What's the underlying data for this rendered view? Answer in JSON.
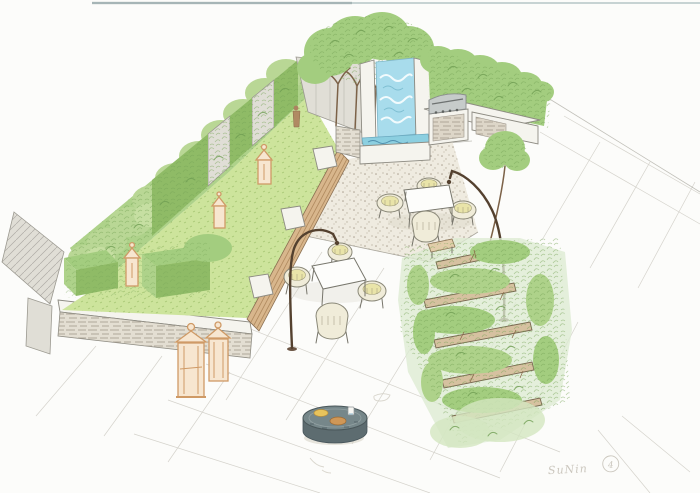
{
  "artwork": {
    "signature": "SuNin",
    "signature_mark": "4"
  },
  "palette": {
    "paper": "#fcfcfa",
    "pencil": "#8d8b82",
    "foliage_light": "#cfe3ae",
    "foliage_mid": "#aed28a",
    "foliage_dark": "#8fbb66",
    "lawn": "#cde49c",
    "water": "#a8dcec",
    "water_deep": "#5f9fbe",
    "gravel": "#efebe0",
    "wood": "#d8b68c",
    "sleeper": "#d6c1a0",
    "stone": "#e0ded6",
    "steel": "#c6cbca",
    "lantern": "#cf9a66",
    "metal_dark": "#5d6c70"
  },
  "features": {
    "illustration": "Hand-drawn walled garden design, aerial perspective sketch with watercolor",
    "boundary_wall": "Climber-clad boundary wall with clipped hedge panels and recesses",
    "wall_lanterns": "Lanterns and ornament along the wall recesses",
    "pleached_trees": "Row of pleached trees against the back wall",
    "water_feature": "Water wall cascading into a raised basin",
    "bbq_counter": "Outdoor kitchen counter with stainless barbecue grill",
    "back_hedge": "Tall loose hedge behind the barbecue",
    "corner_tree": "Small multi-stem tree at the terrace corner",
    "gravel_terrace": "Self-binding gravel dining terrace",
    "dining_set": "Rectangular dining table with four wicker chairs",
    "lounge_set": "Square table with four wicker chairs on paving",
    "timber_bench": "Long timber slat bench with stone block dividers",
    "raised_lawn": "Raised lawn bed with clipped box cubes",
    "stone_wall": "Low dry-stone retaining wall",
    "floor_lanterns": "Pair of tall candle lanterns on the paving",
    "arc_lamps": "Two arched garden lamps",
    "sleeper_planting": "Stepped timber sleepers with loose naturalistic planting",
    "fire_table": "Round stone drinks table with bowls",
    "paving": "Large-format paving slabs",
    "signature": "Artist signature with circled number"
  }
}
